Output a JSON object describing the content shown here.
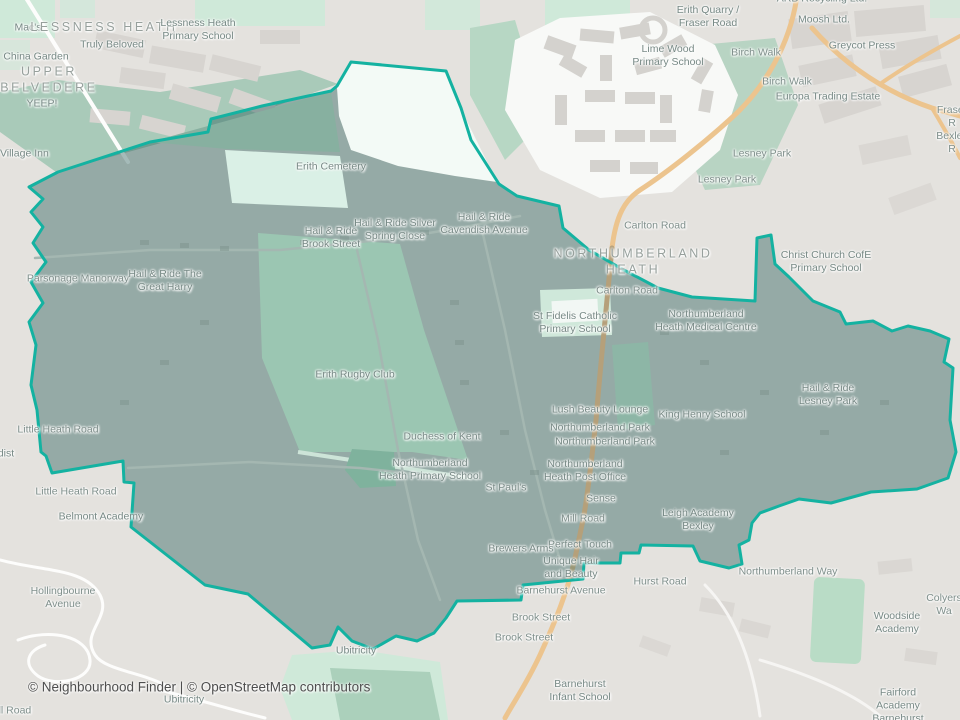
{
  "attribution": {
    "text": "© Neighbourhood Finder | © OpenStreetMap contributors",
    "x": 28,
    "y": 687
  },
  "region": {
    "name": "NORTHUMBERLAND HEATH"
  },
  "colors": {
    "boundary_stroke": "#14b2a1",
    "boundary_fill": "rgba(20,80,75,0.38)",
    "base_ground": "#e4e2de",
    "park_green": "#cfe9d9",
    "woodland_green": "#a9cab9",
    "orange_road": "#ecc48e",
    "building_gray": "#d7d4d0",
    "estate_white": "#f8f9f7",
    "cemetery_mint": "#daf0e6",
    "quarry_white": "#f3faf6",
    "inside_park": "#9bc6b2",
    "label_text": "#778985"
  },
  "boundary": {
    "points": "58,172 150,142 208,132 211,119 262,106 331,91 337,86 351,62 446,71 461,108 471,140 499,184 517,196 559,206 563,228 589,250 622,269 658,288 692,297 755,301 757,238 771,235 775,264 789,277 813,301 840,312 846,324 873,321 892,331 908,326 930,331 949,339 944,362 953,368 950,420 956,452 948,478 917,489 871,492 831,503 799,499 779,506 760,513 752,523 749,540 739,545 742,564 729,568 700,561 693,546 641,545 639,553 621,553 620,563 584,563 583,579 523,585 521,600 457,601 446,618 434,633 417,641 396,636 373,649 352,641 338,627 330,645 312,648 248,594 205,585 131,527 134,483 124,482 123,461 52,473 46,456 41,452 37,410 31,385 36,345 29,322 43,303 31,282 46,262 33,243 43,227 31,212 43,199 29,187"
  },
  "labels": [
    {
      "t": "Mac's",
      "x": 28,
      "y": 28,
      "k": "poi"
    },
    {
      "t": "LESSNESS HEATH",
      "x": 104,
      "y": 28,
      "k": "place"
    },
    {
      "t": "Lessness Heath\nPrimary School",
      "x": 198,
      "y": 30,
      "k": "poi"
    },
    {
      "t": "Truly Beloved",
      "x": 112,
      "y": 45,
      "k": "poi"
    },
    {
      "t": "China Garden",
      "x": 36,
      "y": 57,
      "k": "poi"
    },
    {
      "t": "UPPER\nBELVEDERE",
      "x": 49,
      "y": 80,
      "k": "place"
    },
    {
      "t": "YEEP!",
      "x": 42,
      "y": 104,
      "k": "poi"
    },
    {
      "t": "e Village Inn",
      "x": 20,
      "y": 154,
      "k": "poi"
    },
    {
      "t": "ARB Recycling Ltd.",
      "x": 822,
      "y": -1,
      "k": "poi"
    },
    {
      "t": "Erith Quarry /\nFraser Road",
      "x": 708,
      "y": 17,
      "k": "poi"
    },
    {
      "t": "Moosh Ltd.",
      "x": 824,
      "y": 20,
      "k": "poi"
    },
    {
      "t": "Lime Wood\nPrimary School",
      "x": 668,
      "y": 56,
      "k": "poi"
    },
    {
      "t": "Greycot Press",
      "x": 862,
      "y": 46,
      "k": "poi"
    },
    {
      "t": "Birch Walk",
      "x": 756,
      "y": 53,
      "k": "road"
    },
    {
      "t": "Birch Walk",
      "x": 787,
      "y": 82,
      "k": "road"
    },
    {
      "t": "Europa Trading Estate",
      "x": 828,
      "y": 97,
      "k": "poi"
    },
    {
      "t": "Fraser R\nBexley R",
      "x": 952,
      "y": 130,
      "k": "road"
    },
    {
      "t": "Lesney Park",
      "x": 762,
      "y": 154,
      "k": "road"
    },
    {
      "t": "Lesney Park",
      "x": 727,
      "y": 180,
      "k": "road"
    },
    {
      "t": "Erith Cemetery",
      "x": 331,
      "y": 167,
      "k": "poi"
    },
    {
      "t": "Hail & Ride\nCavendish Avenue",
      "x": 484,
      "y": 224,
      "k": "poi"
    },
    {
      "t": "Hail & Ride Silver\nSpring Close",
      "x": 395,
      "y": 230,
      "k": "poi"
    },
    {
      "t": "Hail & Ride\nBrook Street",
      "x": 331,
      "y": 238,
      "k": "poi"
    },
    {
      "t": "Carlton Road",
      "x": 655,
      "y": 226,
      "k": "road"
    },
    {
      "t": "NORTHUMBERLAND\nHEATH",
      "x": 633,
      "y": 262,
      "k": "place"
    },
    {
      "t": "Christ Church CofE\nPrimary School",
      "x": 826,
      "y": 262,
      "k": "poi"
    },
    {
      "t": "Parsonage Manorway",
      "x": 78,
      "y": 279,
      "k": "road"
    },
    {
      "t": "Hail & Ride The\nGreat Harry",
      "x": 165,
      "y": 281,
      "k": "poi"
    },
    {
      "t": "Carlton Road",
      "x": 627,
      "y": 291,
      "k": "road"
    },
    {
      "t": "St Fidelis Catholic\nPrimary School",
      "x": 575,
      "y": 323,
      "k": "poi"
    },
    {
      "t": "Northumberland\nHeath Medical Centre",
      "x": 706,
      "y": 321,
      "k": "poi"
    },
    {
      "t": "Erith Rugby Club",
      "x": 355,
      "y": 375,
      "k": "poi"
    },
    {
      "t": "Hail & Ride\nLesney Park",
      "x": 828,
      "y": 395,
      "k": "poi"
    },
    {
      "t": "Lush Beauty Lounge",
      "x": 600,
      "y": 410,
      "k": "poi"
    },
    {
      "t": "King Henry School",
      "x": 702,
      "y": 415,
      "k": "poi"
    },
    {
      "t": "Northumberland Park",
      "x": 600,
      "y": 428,
      "k": "poi"
    },
    {
      "t": "Little Heath Road",
      "x": 58,
      "y": 430,
      "k": "road"
    },
    {
      "t": "Duchess of Kent",
      "x": 442,
      "y": 437,
      "k": "poi"
    },
    {
      "t": "Northumberland Park",
      "x": 605,
      "y": 442,
      "k": "poi"
    },
    {
      "t": "dist",
      "x": 6,
      "y": 454,
      "k": "poi"
    },
    {
      "t": "Northumberland\nHeath Primary School",
      "x": 430,
      "y": 470,
      "k": "poi"
    },
    {
      "t": "Northumberland\nHeath Post Office",
      "x": 585,
      "y": 471,
      "k": "poi"
    },
    {
      "t": "St Paul's",
      "x": 506,
      "y": 488,
      "k": "poi"
    },
    {
      "t": "Little Heath Road",
      "x": 76,
      "y": 492,
      "k": "road"
    },
    {
      "t": "Sense",
      "x": 601,
      "y": 499,
      "k": "poi"
    },
    {
      "t": "Belmont Academy",
      "x": 101,
      "y": 517,
      "k": "poi"
    },
    {
      "t": "Mill Road",
      "x": 583,
      "y": 519,
      "k": "road"
    },
    {
      "t": "Leigh Academy\nBexley",
      "x": 698,
      "y": 520,
      "k": "poi"
    },
    {
      "t": "Perfect Touch",
      "x": 580,
      "y": 545,
      "k": "poi"
    },
    {
      "t": "Brewers Arms",
      "x": 521,
      "y": 549,
      "k": "poi"
    },
    {
      "t": "Unique Hair\nand Beauty",
      "x": 571,
      "y": 568,
      "k": "poi"
    },
    {
      "t": "Northumberland Way",
      "x": 788,
      "y": 572,
      "k": "road"
    },
    {
      "t": "Hurst Road",
      "x": 660,
      "y": 582,
      "k": "road"
    },
    {
      "t": "Barnehurst Avenue",
      "x": 561,
      "y": 591,
      "k": "road"
    },
    {
      "t": "Hollingbourne\nAvenue",
      "x": 63,
      "y": 598,
      "k": "road"
    },
    {
      "t": "Colyers Wa",
      "x": 944,
      "y": 605,
      "k": "road"
    },
    {
      "t": "Brook Street",
      "x": 541,
      "y": 618,
      "k": "road"
    },
    {
      "t": "Woodside Academy",
      "x": 897,
      "y": 623,
      "k": "poi"
    },
    {
      "t": "Brook Street",
      "x": 524,
      "y": 638,
      "k": "road"
    },
    {
      "t": "Ubitricity",
      "x": 356,
      "y": 651,
      "k": "poi"
    },
    {
      "t": "Barnehurst\nInfant School",
      "x": 580,
      "y": 691,
      "k": "poi"
    },
    {
      "t": "Ubitricity",
      "x": 184,
      "y": 700,
      "k": "poi"
    },
    {
      "t": "Fairford Academy\nBarnehurst",
      "x": 898,
      "y": 706,
      "k": "poi"
    },
    {
      "t": "ell Road",
      "x": 12,
      "y": 711,
      "k": "road"
    }
  ]
}
